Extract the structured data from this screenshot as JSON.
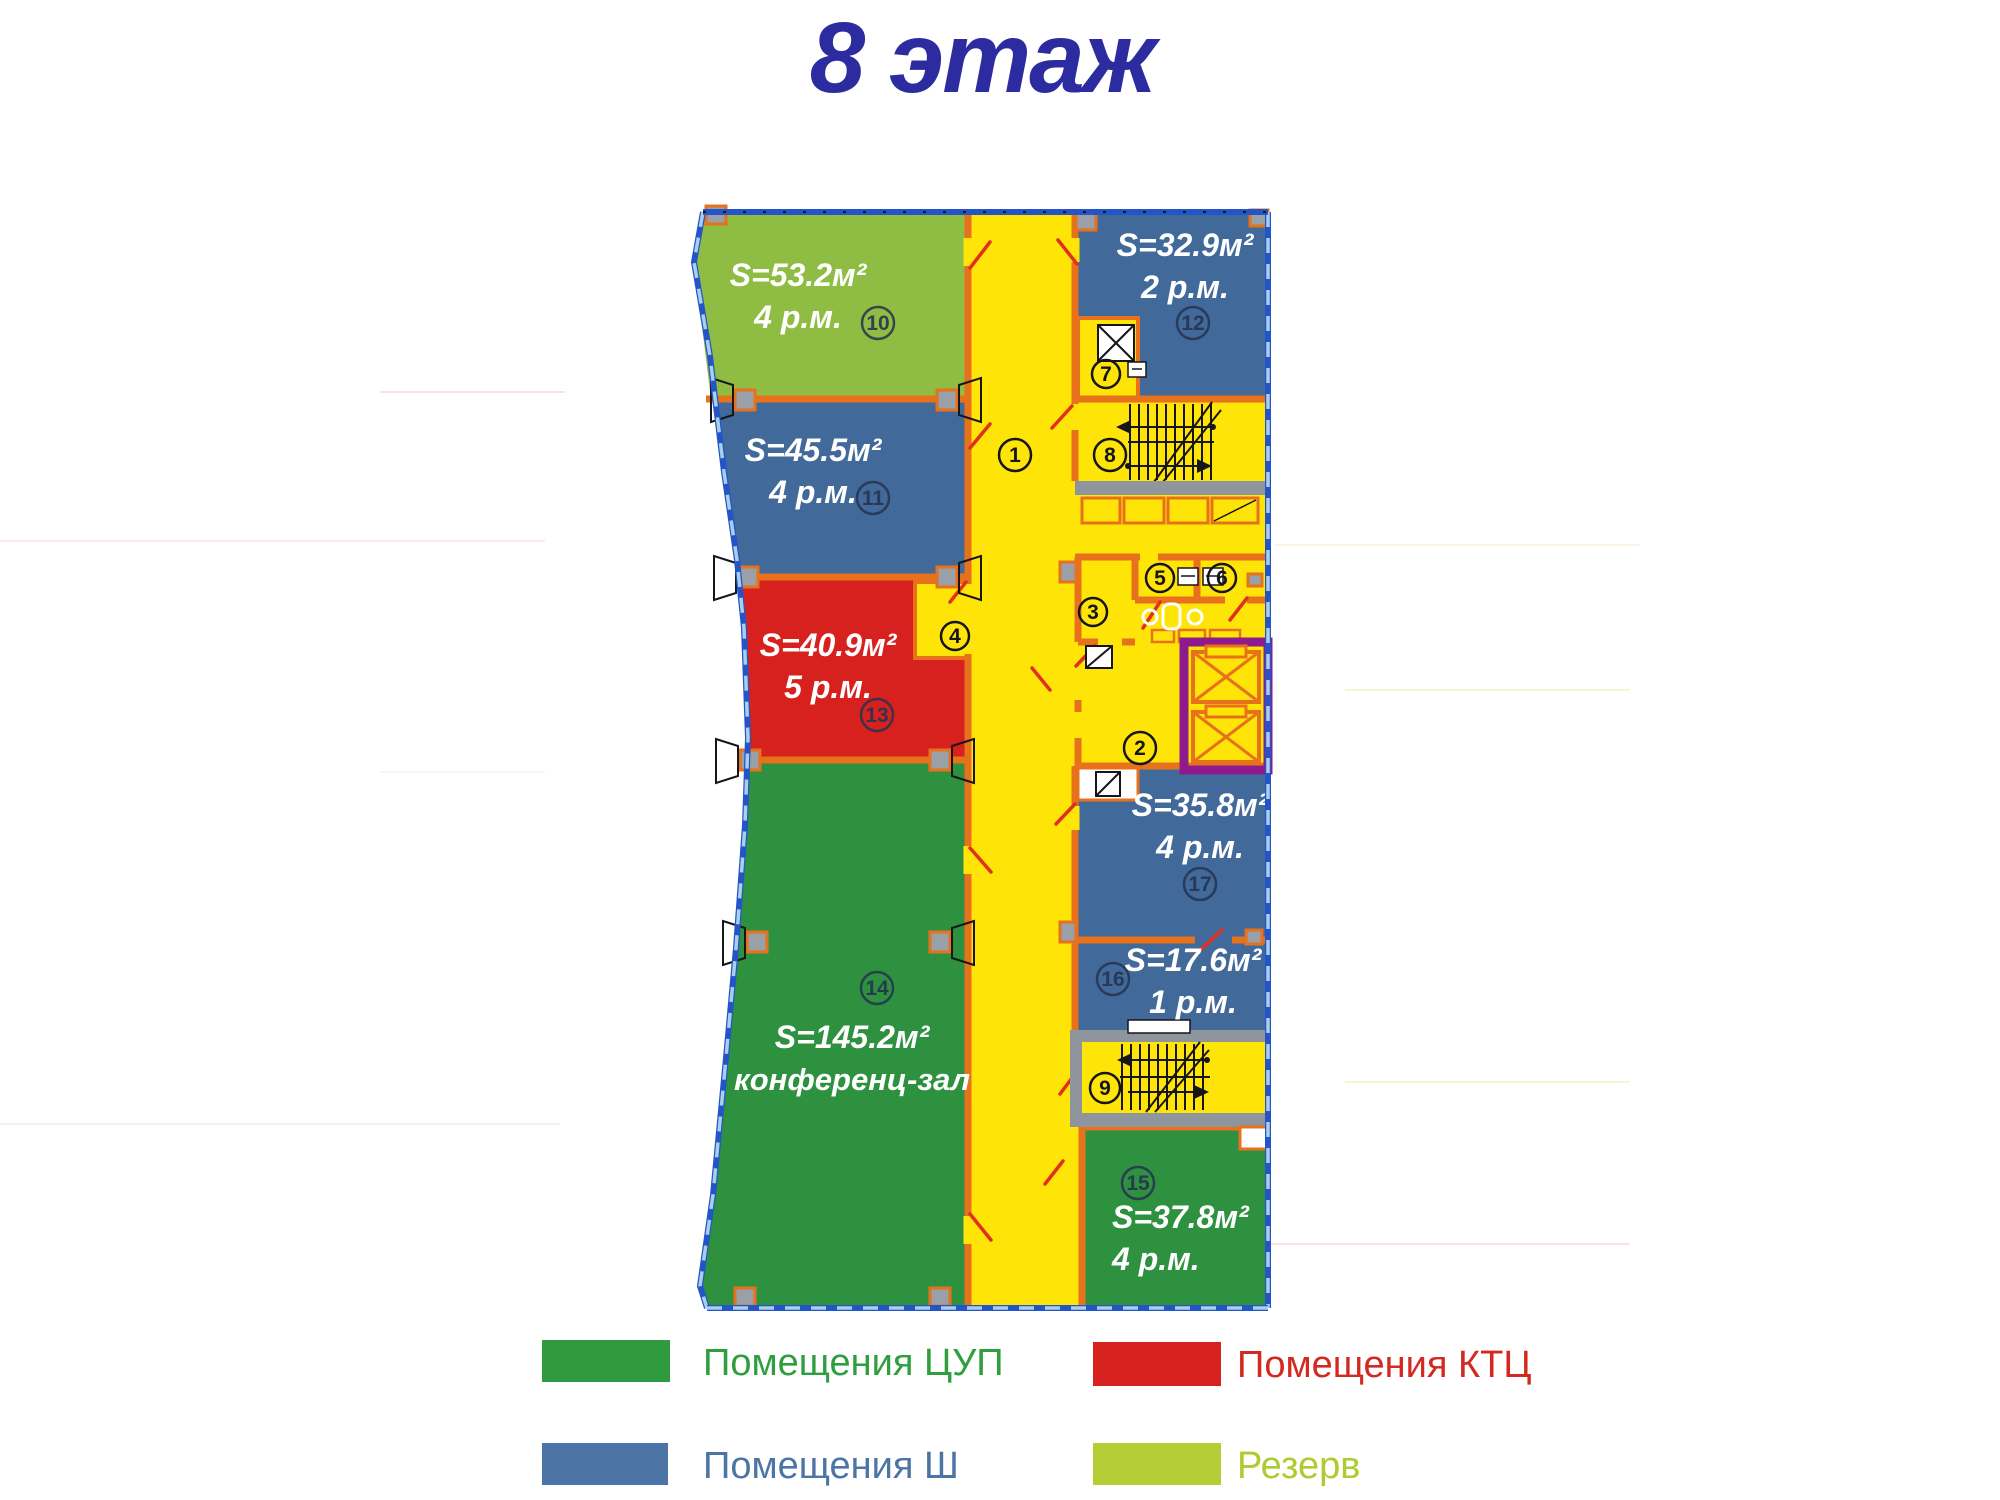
{
  "title": "8 этаж",
  "colors": {
    "title": "#2C2CA0",
    "corridor": "#FFE408",
    "wall": "#E8711C",
    "cup": "#2E9140",
    "sh": "#41699A",
    "ktc": "#D7211E",
    "reserve": "#8FBC42",
    "legend_cup_swatch": "#2F9A40",
    "legend_ktc_swatch": "#D7211E",
    "legend_sh_swatch": "#4C74A4",
    "legend_reserve_swatch": "#B5CE36",
    "legend_cup_text": "#2F9E3F",
    "legend_ktc_text": "#D22920",
    "legend_sh_text": "#4C74A4",
    "legend_reserve_text": "#AECB2F",
    "border": "#2355C8",
    "window": "#A9CFEA",
    "elevator": "#8E1A8E"
  },
  "plan": {
    "rooms": {
      "r10": {
        "area": "S=53.2м²",
        "cap": "4 р.м.",
        "num": "10",
        "type": "Резерв"
      },
      "r11": {
        "area": "S=45.5м²",
        "cap": "4 р.м.",
        "num": "11",
        "type": "Помещения Ш"
      },
      "r13": {
        "area": "S=40.9м²",
        "cap": "5 р.м.",
        "num": "13",
        "type": "Помещения КТЦ"
      },
      "r14": {
        "area": "S=145.2м²",
        "cap": "конференц-зал",
        "num": "14",
        "type": "Помещения ЦУП"
      },
      "r12": {
        "area": "S=32.9м²",
        "cap": "2 р.м.",
        "num": "12",
        "type": "Помещения Ш"
      },
      "r17": {
        "area": "S=35.8м²",
        "cap": "4 р.м.",
        "num": "17",
        "type": "Помещения Ш"
      },
      "r16": {
        "area": "S=17.6м²",
        "cap": "1 р.м.",
        "num": "16",
        "type": "Помещения Ш"
      },
      "r15": {
        "area": "S=37.8м²",
        "cap": "4 р.м.",
        "num": "15",
        "type": "Помещения ЦУП"
      }
    },
    "markers": {
      "m1": "1",
      "m2": "2",
      "m3": "3",
      "m4": "4",
      "m5": "5",
      "m6": "6",
      "m7": "7",
      "m8": "8",
      "m9": "9"
    }
  },
  "legend": {
    "items": [
      {
        "label": "Помещения ЦУП"
      },
      {
        "label": "Помещения КТЦ"
      },
      {
        "label": "Помещения Ш"
      },
      {
        "label": "Резерв"
      }
    ]
  }
}
